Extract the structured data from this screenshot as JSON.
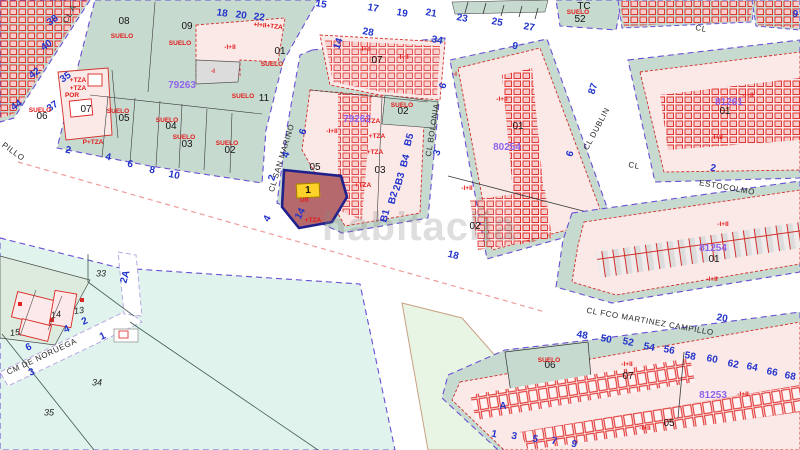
{
  "map": {
    "watermark": "habitaclia",
    "highlight": {
      "label": "1",
      "sub": "UR"
    },
    "colors": {
      "parcel_green": "#c7dacf",
      "building_pink": "#fbe9e8",
      "building_red": "#dd2422",
      "open_cyan": "#e0f4ed",
      "open_pale_green": "#e9f5e4",
      "block_boundary_violet": "#6a4fd4",
      "street_number_blue": "#2233cc",
      "cadastral_purple": "#8f63ea",
      "label_red": "#e31a1a",
      "highlight_fill": "#b5696d",
      "highlight_border": "#20208c",
      "highlight_tag_yellow": "#fcd12a",
      "dashed_line_red": "#ef9a9a"
    },
    "labels": [
      {
        "t": "CL A",
        "x": 70,
        "y": 14,
        "r": -62,
        "k": "st"
      },
      {
        "t": "PILLO",
        "x": 13,
        "y": 152,
        "r": 36,
        "k": "st"
      },
      {
        "t": "CL  SAN  MARINO",
        "x": 282,
        "y": 158,
        "r": -73,
        "k": "st"
      },
      {
        "t": "CL BOLONIA",
        "x": 433,
        "y": 130,
        "r": -81,
        "k": "st"
      },
      {
        "t": "CL DUBLIN",
        "x": 597,
        "y": 129,
        "r": -62,
        "k": "st"
      },
      {
        "t": "CL",
        "x": 701,
        "y": 29,
        "r": 12,
        "k": "st"
      },
      {
        "t": "CL",
        "x": 634,
        "y": 166,
        "r": 10,
        "k": "st"
      },
      {
        "t": "ESTOCOLMO",
        "x": 727,
        "y": 188,
        "r": 10,
        "k": "st"
      },
      {
        "t": "CL FCO MARTINEZ CAMPILLO",
        "x": 650,
        "y": 322,
        "r": 10,
        "k": "st"
      },
      {
        "t": "CM DE NORUEGA",
        "x": 42,
        "y": 357,
        "r": -25,
        "k": "st"
      },
      {
        "t": "38",
        "x": 53,
        "y": 21,
        "r": -35,
        "k": "bl"
      },
      {
        "t": "40",
        "x": 47,
        "y": 46,
        "r": -35,
        "k": "bl"
      },
      {
        "t": "42",
        "x": 35,
        "y": 74,
        "r": -35,
        "k": "bl"
      },
      {
        "t": "44",
        "x": 17,
        "y": 106,
        "r": -35,
        "k": "bl"
      },
      {
        "t": "35",
        "x": 66,
        "y": 78,
        "r": -35,
        "k": "bl"
      },
      {
        "t": "37",
        "x": 53,
        "y": 107,
        "r": -35,
        "k": "bl"
      },
      {
        "t": "18",
        "x": 222,
        "y": 14,
        "r": 8,
        "k": "bl"
      },
      {
        "t": "20",
        "x": 241,
        "y": 16,
        "r": 8,
        "k": "bl"
      },
      {
        "t": "22",
        "x": 259,
        "y": 18,
        "r": 8,
        "k": "bl"
      },
      {
        "t": "15",
        "x": 321,
        "y": 5,
        "r": 10,
        "k": "bl"
      },
      {
        "t": "17",
        "x": 373,
        "y": 9,
        "r": 10,
        "k": "bl"
      },
      {
        "t": "19",
        "x": 402,
        "y": 14,
        "r": 10,
        "k": "bl"
      },
      {
        "t": "21",
        "x": 431,
        "y": 14,
        "r": 10,
        "k": "bl"
      },
      {
        "t": "23",
        "x": 462,
        "y": 19,
        "r": 10,
        "k": "bl"
      },
      {
        "t": "25",
        "x": 497,
        "y": 23,
        "r": 10,
        "k": "bl"
      },
      {
        "t": "27",
        "x": 529,
        "y": 28,
        "r": 10,
        "k": "bl"
      },
      {
        "t": "28",
        "x": 368,
        "y": 33,
        "r": 10,
        "k": "bl"
      },
      {
        "t": "34",
        "x": 437,
        "y": 41,
        "r": 10,
        "k": "bl"
      },
      {
        "t": "14",
        "x": 339,
        "y": 44,
        "r": -70,
        "k": "bl"
      },
      {
        "t": "14",
        "x": 301,
        "y": 214,
        "r": -62,
        "k": "bl"
      },
      {
        "t": "6",
        "x": 304,
        "y": 132,
        "r": -72,
        "k": "bl"
      },
      {
        "t": "4",
        "x": 287,
        "y": 155,
        "r": -72,
        "k": "bl"
      },
      {
        "t": "2",
        "x": 273,
        "y": 178,
        "r": -72,
        "k": "bl"
      },
      {
        "t": "4",
        "x": 268,
        "y": 219,
        "r": -62,
        "k": "bl"
      },
      {
        "t": "B5",
        "x": 410,
        "y": 140,
        "r": -75,
        "k": "bl"
      },
      {
        "t": "B4",
        "x": 406,
        "y": 161,
        "r": -75,
        "k": "bl"
      },
      {
        "t": "B3",
        "x": 401,
        "y": 179,
        "r": -75,
        "k": "bl"
      },
      {
        "t": "2",
        "x": 398,
        "y": 188,
        "r": -75,
        "k": "bl"
      },
      {
        "t": "B2",
        "x": 394,
        "y": 198,
        "r": -75,
        "k": "bl"
      },
      {
        "t": "B1",
        "x": 386,
        "y": 216,
        "r": -75,
        "k": "bl"
      },
      {
        "t": "18",
        "x": 453,
        "y": 256,
        "r": 14,
        "k": "bl"
      },
      {
        "t": "2",
        "x": 68,
        "y": 151,
        "r": 12,
        "k": "bl"
      },
      {
        "t": "4",
        "x": 108,
        "y": 158,
        "r": 12,
        "k": "bl"
      },
      {
        "t": "6",
        "x": 130,
        "y": 165,
        "r": 12,
        "k": "bl"
      },
      {
        "t": "8",
        "x": 152,
        "y": 171,
        "r": 12,
        "k": "bl"
      },
      {
        "t": "10",
        "x": 174,
        "y": 176,
        "r": 12,
        "k": "bl"
      },
      {
        "t": "9",
        "x": 515,
        "y": 47,
        "r": 10,
        "k": "bl"
      },
      {
        "t": "6",
        "x": 444,
        "y": 86,
        "r": -72,
        "k": "bl"
      },
      {
        "t": "3",
        "x": 438,
        "y": 153,
        "r": -72,
        "k": "bl"
      },
      {
        "t": "87",
        "x": 594,
        "y": 89,
        "r": -72,
        "k": "bl"
      },
      {
        "t": "6",
        "x": 571,
        "y": 154,
        "r": -72,
        "k": "bl"
      },
      {
        "t": "9",
        "x": 795,
        "y": 15,
        "r": 12,
        "k": "bl"
      },
      {
        "t": "2",
        "x": 713,
        "y": 169,
        "r": 10,
        "k": "bl"
      },
      {
        "t": "20",
        "x": 722,
        "y": 319,
        "r": 10,
        "k": "bl"
      },
      {
        "t": "48",
        "x": 582,
        "y": 336,
        "r": 11,
        "k": "bl"
      },
      {
        "t": "50",
        "x": 606,
        "y": 340,
        "r": 11,
        "k": "bl"
      },
      {
        "t": "52",
        "x": 628,
        "y": 343,
        "r": 11,
        "k": "bl"
      },
      {
        "t": "54",
        "x": 649,
        "y": 348,
        "r": 11,
        "k": "bl"
      },
      {
        "t": "56",
        "x": 669,
        "y": 351,
        "r": 11,
        "k": "bl"
      },
      {
        "t": "58",
        "x": 690,
        "y": 357,
        "r": 11,
        "k": "bl"
      },
      {
        "t": "60",
        "x": 712,
        "y": 360,
        "r": 11,
        "k": "bl"
      },
      {
        "t": "62",
        "x": 733,
        "y": 365,
        "r": 11,
        "k": "bl"
      },
      {
        "t": "64",
        "x": 752,
        "y": 368,
        "r": 11,
        "k": "bl"
      },
      {
        "t": "66",
        "x": 772,
        "y": 373,
        "r": 11,
        "k": "bl"
      },
      {
        "t": "68",
        "x": 790,
        "y": 377,
        "r": 11,
        "k": "bl"
      },
      {
        "t": "A",
        "x": 503,
        "y": 407,
        "r": 0,
        "k": "bl"
      },
      {
        "t": "1",
        "x": 494,
        "y": 435,
        "r": 12,
        "k": "bl"
      },
      {
        "t": "3",
        "x": 514,
        "y": 437,
        "r": 12,
        "k": "bl"
      },
      {
        "t": "5",
        "x": 535,
        "y": 440,
        "r": 12,
        "k": "bl"
      },
      {
        "t": "7",
        "x": 554,
        "y": 442,
        "r": 12,
        "k": "bl"
      },
      {
        "t": "9",
        "x": 574,
        "y": 445,
        "r": 12,
        "k": "bl"
      },
      {
        "t": "2A",
        "x": 126,
        "y": 277,
        "r": -75,
        "k": "bl"
      },
      {
        "t": "2",
        "x": 85,
        "y": 322,
        "r": -24,
        "k": "bl"
      },
      {
        "t": "4",
        "x": 67,
        "y": 330,
        "r": -24,
        "k": "bl"
      },
      {
        "t": "6",
        "x": 29,
        "y": 348,
        "r": -24,
        "k": "bl"
      },
      {
        "t": "1",
        "x": 103,
        "y": 337,
        "r": -24,
        "k": "bl"
      },
      {
        "t": "3",
        "x": 32,
        "y": 373,
        "r": -24,
        "k": "bl"
      },
      {
        "t": "08",
        "x": 124,
        "y": 22,
        "k": "pn"
      },
      {
        "t": "09",
        "x": 187,
        "y": 27,
        "k": "pn"
      },
      {
        "t": "01",
        "x": 280,
        "y": 52,
        "k": "pn"
      },
      {
        "t": "11",
        "x": 264,
        "y": 99,
        "k": "pn"
      },
      {
        "t": "07",
        "x": 86,
        "y": 110,
        "k": "pn"
      },
      {
        "t": "06",
        "x": 42,
        "y": 117,
        "k": "pn"
      },
      {
        "t": "05",
        "x": 124,
        "y": 119,
        "k": "pn"
      },
      {
        "t": "04",
        "x": 171,
        "y": 127,
        "k": "pn"
      },
      {
        "t": "03",
        "x": 187,
        "y": 145,
        "k": "pn"
      },
      {
        "t": "02",
        "x": 230,
        "y": 151,
        "k": "pn"
      },
      {
        "t": "07",
        "x": 377,
        "y": 61,
        "k": "pn"
      },
      {
        "t": "05",
        "x": 315,
        "y": 168,
        "k": "pn"
      },
      {
        "t": "03",
        "x": 380,
        "y": 171,
        "k": "pn"
      },
      {
        "t": "02",
        "x": 403,
        "y": 112,
        "k": "pn"
      },
      {
        "t": "01",
        "x": 518,
        "y": 127,
        "k": "pn"
      },
      {
        "t": "02",
        "x": 475,
        "y": 227,
        "k": "pn"
      },
      {
        "t": "TC",
        "x": 584,
        "y": 7,
        "k": "pn"
      },
      {
        "t": "52",
        "x": 580,
        "y": 20,
        "k": "pn"
      },
      {
        "t": "01",
        "x": 725,
        "y": 112,
        "k": "pn"
      },
      {
        "t": "01",
        "x": 714,
        "y": 260,
        "k": "pn"
      },
      {
        "t": "06",
        "x": 550,
        "y": 366,
        "k": "pn"
      },
      {
        "t": "07",
        "x": 628,
        "y": 377,
        "k": "pn"
      },
      {
        "t": "05",
        "x": 669,
        "y": 424,
        "k": "pn"
      },
      {
        "t": "33",
        "x": 101,
        "y": 274,
        "k": "it"
      },
      {
        "t": "34",
        "x": 97,
        "y": 383,
        "k": "it"
      },
      {
        "t": "35",
        "x": 49,
        "y": 413,
        "k": "it"
      },
      {
        "t": "13",
        "x": 79,
        "y": 311,
        "r": -8,
        "k": "it"
      },
      {
        "t": "14",
        "x": 56,
        "y": 315,
        "r": -8,
        "k": "it"
      },
      {
        "t": "15",
        "x": 15,
        "y": 333,
        "r": -8,
        "k": "it"
      },
      {
        "t": "SUELO",
        "x": 122,
        "y": 37,
        "k": "rd"
      },
      {
        "t": "SUELO",
        "x": 180,
        "y": 44,
        "k": "rd"
      },
      {
        "t": "SUELO",
        "x": 272,
        "y": 65,
        "k": "rd"
      },
      {
        "t": "SUELO",
        "x": 243,
        "y": 97,
        "k": "rd"
      },
      {
        "t": "SUELO",
        "x": 40,
        "y": 111,
        "k": "rd"
      },
      {
        "t": "SUELO",
        "x": 118,
        "y": 112,
        "k": "rd"
      },
      {
        "t": "SUELO",
        "x": 167,
        "y": 121,
        "k": "rd"
      },
      {
        "t": "SUELO",
        "x": 184,
        "y": 138,
        "k": "rd"
      },
      {
        "t": "SUELO",
        "x": 227,
        "y": 144,
        "k": "rd"
      },
      {
        "t": "SUELO",
        "x": 402,
        "y": 106,
        "k": "rd"
      },
      {
        "t": "SUELO",
        "x": 578,
        "y": 13,
        "k": "rd"
      },
      {
        "t": "SUELO",
        "x": 549,
        "y": 361,
        "k": "rd"
      },
      {
        "t": "-I+II",
        "x": 230,
        "y": 48,
        "k": "rd"
      },
      {
        "t": "-I+II",
        "x": 365,
        "y": 50,
        "k": "rd"
      },
      {
        "t": "-I+II",
        "x": 403,
        "y": 58,
        "k": "rd"
      },
      {
        "t": "-I+II",
        "x": 332,
        "y": 132,
        "k": "rd"
      },
      {
        "t": "-I+II",
        "x": 502,
        "y": 100,
        "k": "rd"
      },
      {
        "t": "-I+II",
        "x": 467,
        "y": 189,
        "k": "rd"
      },
      {
        "t": "-I+II",
        "x": 717,
        "y": 138,
        "k": "rd"
      },
      {
        "t": "-I+II",
        "x": 748,
        "y": 96,
        "k": "rd"
      },
      {
        "t": "-I+II",
        "x": 723,
        "y": 225,
        "k": "rd"
      },
      {
        "t": "-I+II",
        "x": 712,
        "y": 280,
        "k": "rd"
      },
      {
        "t": "-I+II",
        "x": 627,
        "y": 365,
        "k": "rd"
      },
      {
        "t": "-I+II",
        "x": 645,
        "y": 429,
        "k": "rd"
      },
      {
        "t": "-I+II",
        "x": 743,
        "y": 395,
        "k": "rd"
      },
      {
        "t": "-I",
        "x": 213,
        "y": 72,
        "k": "rd"
      },
      {
        "t": "-I",
        "x": 455,
        "y": 75,
        "k": "rd"
      },
      {
        "t": "+TZA",
        "x": 78,
        "y": 81,
        "k": "rd"
      },
      {
        "t": "+TZA",
        "x": 78,
        "y": 89,
        "k": "rd"
      },
      {
        "t": "POR",
        "x": 72,
        "y": 96,
        "k": "rd"
      },
      {
        "t": "P+TZA",
        "x": 93,
        "y": 143,
        "k": "rd"
      },
      {
        "t": "+TZA",
        "x": 372,
        "y": 122,
        "k": "rd"
      },
      {
        "t": "+TZA",
        "x": 377,
        "y": 137,
        "k": "rd"
      },
      {
        "t": "+TZA",
        "x": 375,
        "y": 153,
        "k": "rd"
      },
      {
        "t": "+TZA",
        "x": 363,
        "y": 186,
        "k": "rd"
      },
      {
        "t": "+TZA",
        "x": 313,
        "y": 221,
        "k": "rd"
      },
      {
        "t": "+I+II+TZA",
        "x": 268,
        "y": 27,
        "r": 6,
        "k": "rd"
      },
      {
        "t": "79263",
        "x": 182,
        "y": 86,
        "k": "pu"
      },
      {
        "t": "79262",
        "x": 357,
        "y": 120,
        "k": "pu"
      },
      {
        "t": "80254",
        "x": 507,
        "y": 148,
        "k": "pu"
      },
      {
        "t": "81254",
        "x": 713,
        "y": 249,
        "k": "pu"
      },
      {
        "t": "81261",
        "x": 729,
        "y": 103,
        "k": "pu"
      },
      {
        "t": "81253",
        "x": 713,
        "y": 396,
        "k": "pu"
      }
    ]
  }
}
